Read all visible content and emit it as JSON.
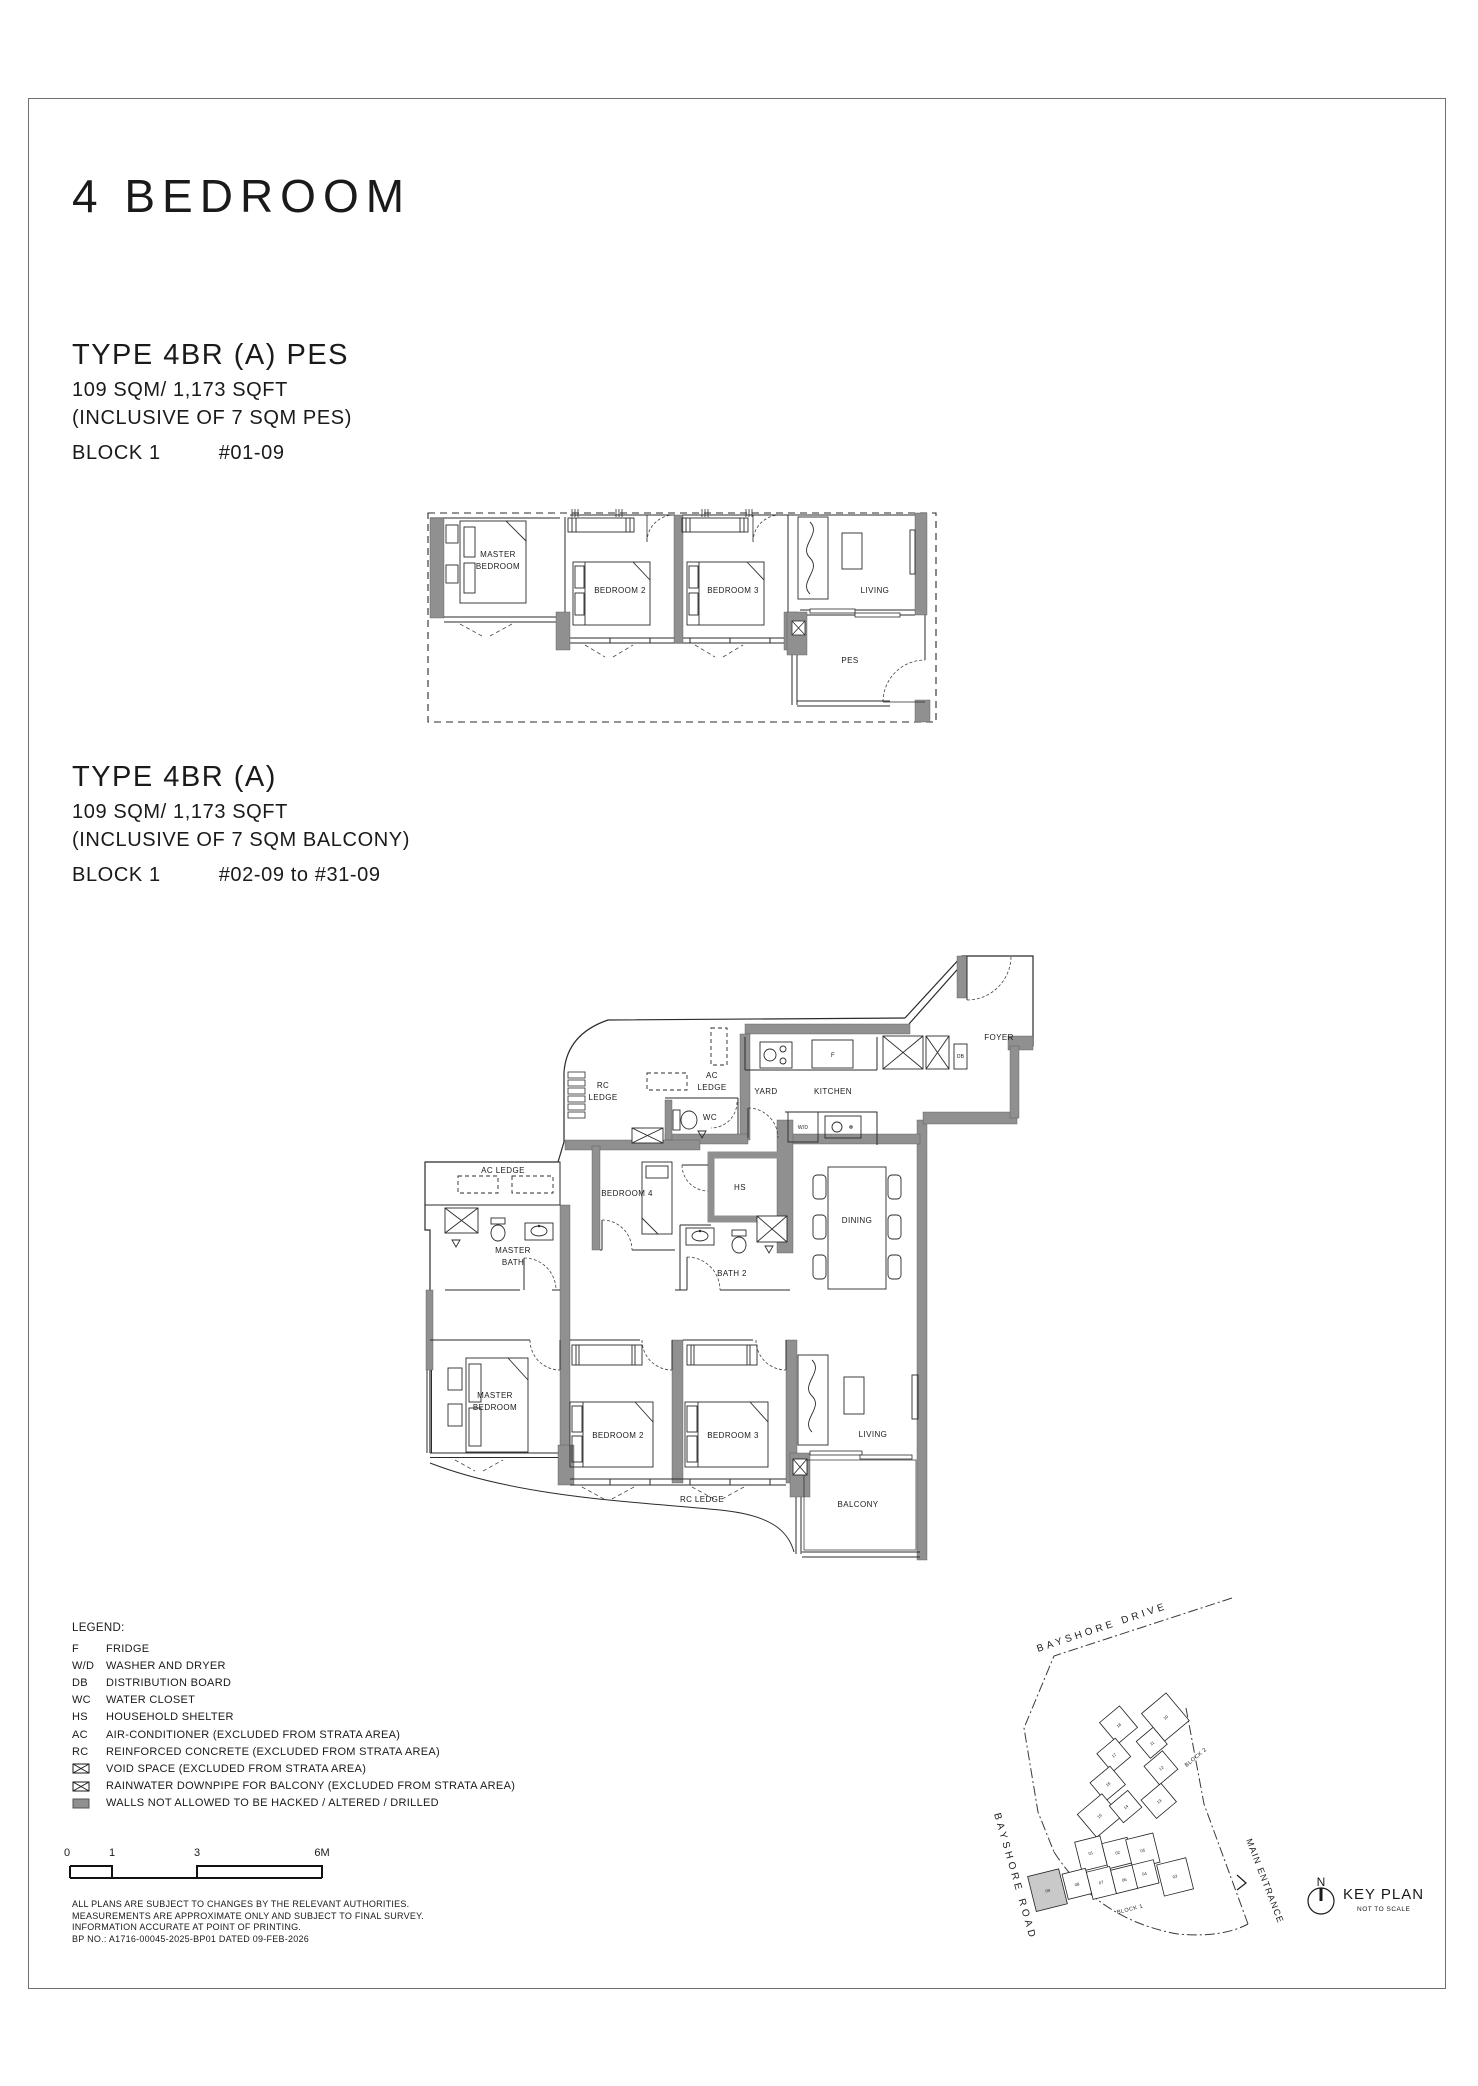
{
  "page": {
    "title": "4 BEDROOM"
  },
  "sections": {
    "pes": {
      "title": "TYPE 4BR (A) PES",
      "area": "109 SQM/ 1,173 SQFT",
      "inclusive": "(INCLUSIVE OF 7 SQM PES)",
      "block": "BLOCK 1",
      "units": "#01-09"
    },
    "balcony": {
      "title": "TYPE 4BR (A)",
      "area": "109 SQM/ 1,173 SQFT",
      "inclusive": "(INCLUSIVE OF 7 SQM BALCONY)",
      "block": "BLOCK 1",
      "units": "#02-09 to #31-09"
    }
  },
  "plan_pes": {
    "rooms": {
      "master": [
        "MASTER",
        "BEDROOM"
      ],
      "bedroom2": "BEDROOM 2",
      "bedroom3": "BEDROOM 3",
      "living": "LIVING",
      "pes": "PES"
    }
  },
  "plan_main": {
    "rooms": {
      "rc_ledge_top": [
        "RC",
        "LEDGE"
      ],
      "ac_ledge_top": [
        "AC",
        "LEDGE"
      ],
      "ac_ledge_left": "AC LEDGE",
      "rc_ledge_bottom": "RC LEDGE",
      "wc": "WC",
      "yard": "YARD",
      "kitchen": "KITCHEN",
      "foyer": "FOYER",
      "hs": "HS",
      "dining": "DINING",
      "master_bath": [
        "MASTER",
        "BATH"
      ],
      "bath2": "BATH 2",
      "bedroom4": "BEDROOM 4",
      "master": [
        "MASTER",
        "BEDROOM"
      ],
      "bedroom2": "BEDROOM 2",
      "bedroom3": "BEDROOM 3",
      "living": "LIVING",
      "balcony": "BALCONY",
      "fridge": "F",
      "washer_dryer": "W/D",
      "db": "DB"
    }
  },
  "legend": {
    "title": "LEGEND:",
    "items": [
      {
        "abbr": "F",
        "text": "FRIDGE"
      },
      {
        "abbr": "W/D",
        "text": "WASHER AND DRYER"
      },
      {
        "abbr": "DB",
        "text": "DISTRIBUTION BOARD"
      },
      {
        "abbr": "WC",
        "text": "WATER CLOSET"
      },
      {
        "abbr": "HS",
        "text": "HOUSEHOLD SHELTER"
      },
      {
        "abbr": "AC",
        "text": "AIR-CONDITIONER (EXCLUDED FROM STRATA AREA)"
      },
      {
        "abbr": "RC",
        "text": "REINFORCED CONCRETE (EXCLUDED FROM STRATA AREA)"
      },
      {
        "abbr": "",
        "text": "VOID SPACE (EXCLUDED FROM STRATA AREA)"
      },
      {
        "abbr": "",
        "text": "RAINWATER DOWNPIPE FOR BALCONY (EXCLUDED FROM STRATA AREA)"
      },
      {
        "abbr": "",
        "text": "WALLS NOT ALLOWED TO BE HACKED / ALTERED / DRILLED"
      }
    ]
  },
  "scale_bar": {
    "labels": [
      "0",
      "1",
      "3",
      "6M"
    ]
  },
  "disclaimer": {
    "lines": [
      "ALL PLANS ARE SUBJECT TO CHANGES BY THE RELEVANT AUTHORITIES.",
      "MEASUREMENTS ARE APPROXIMATE ONLY AND SUBJECT TO FINAL SURVEY.",
      "INFORMATION ACCURATE AT POINT OF PRINTING.",
      "BP NO.: A1716-00045-2025-BP01 DATED 09-FEB-2026"
    ]
  },
  "key_plan": {
    "title": "KEY PLAN",
    "subtitle": "NOT TO SCALE",
    "north": "N",
    "road_top": "BAYSHORE DRIVE",
    "road_left": "BAYSHORE ROAD",
    "entrance": "MAIN ENTRANCE",
    "block1_label": "BLOCK 1",
    "block2_label": "BLOCK 2",
    "block1_units": [
      "01",
      "02",
      "03",
      "04",
      "05",
      "06",
      "07",
      "08",
      "09"
    ],
    "block2_units": [
      "10",
      "11",
      "12",
      "13",
      "14",
      "15",
      "16",
      "17",
      "18"
    ],
    "highlighted_unit": "09"
  },
  "colors": {
    "wall": "#909090",
    "line": "#2b2b2b",
    "highlight": "#c9c9c9"
  }
}
